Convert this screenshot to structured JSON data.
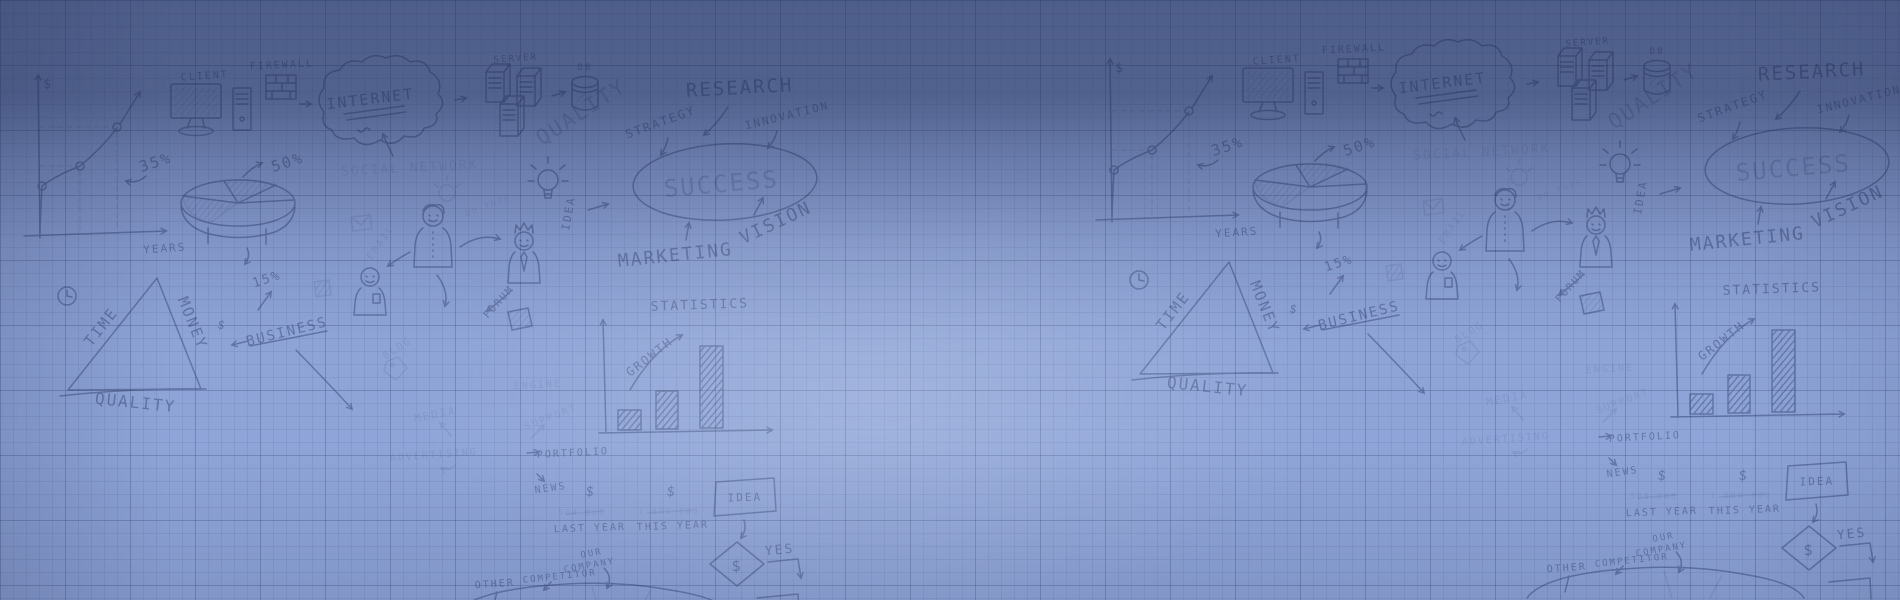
{
  "banner": {
    "colors": {
      "paper": "#94aade",
      "top_shade": "#4e5d8a",
      "bright_center": "#8ba3dc",
      "bottom_left": "#7288c0",
      "grid_line": "#2c3b66",
      "ink": "#22315e"
    },
    "icons": [
      "line-chart-icon",
      "pie-chart-icon",
      "bar-chart-icon",
      "monitor-icon",
      "computer-tower-icon",
      "firewall-bricks-icon",
      "cloud-icon",
      "server-towers-icon",
      "database-cylinder-icon",
      "lightbulb-icon",
      "envelope-icon",
      "person-icon",
      "crowned-person-icon",
      "clock-icon",
      "triangle-icon",
      "price-tag-icon",
      "note-icon",
      "flowchart-box-icon",
      "flowchart-diamond-icon",
      "ellipse-outline-icon",
      "arrow-icon"
    ],
    "words": {
      "client": "CLIENT",
      "firewall": "FIREWALL",
      "internet": "INTERNET",
      "server": "SERVER",
      "db": "DB",
      "quality_upper": "QUALITY",
      "research": "RESEARCH",
      "strategy": "STRATEGY",
      "innovation": "INNOVATION",
      "social_network": "SOCIAL NETWORK",
      "success": "SUCCESS",
      "vision": "VISION",
      "marketing": "MARKETING",
      "statistics": "STATISTICS",
      "growth": "GROWTH",
      "idea_vertical": "IDEA",
      "do_this": "DO THIS",
      "email": "EMAIL",
      "pct_35": "35%",
      "pct_50": "50%",
      "pct_15": "15%",
      "years": "YEARS",
      "time": "TIME",
      "money": "MONEY",
      "quality_lower": "QUALITY",
      "business": "BUSINESS",
      "dollar": "$",
      "blog": "BLOG",
      "media": "MEDIA",
      "advertising": "ADVERTISING",
      "forum": "FORUM",
      "engine": "ENGINE",
      "support": "SUPPORT",
      "portfolio": "PORTFOLIO",
      "news": "NEWS",
      "amount_last": "500.000",
      "last_year": "LAST YEAR",
      "amount_this": "1.000.000",
      "this_year": "THIS YEAR",
      "idea_box": "IDEA",
      "yes": "YES",
      "our": "OUR",
      "company": "COMPANY",
      "competitor": "COMPETITOR",
      "other": "OTHER"
    }
  }
}
